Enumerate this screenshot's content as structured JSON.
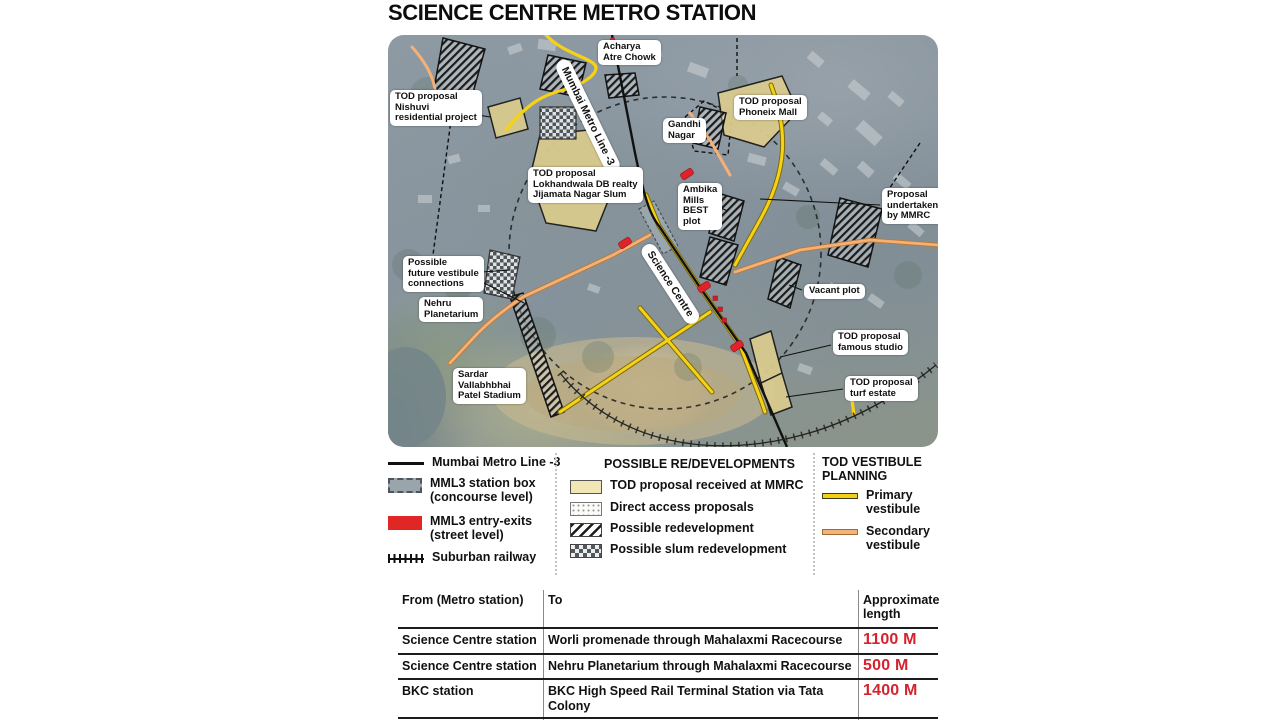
{
  "title": "SCIENCE CENTRE METRO STATION",
  "map": {
    "labels": [
      "Acharya\nAtre Chowk",
      "TOD proposal\nNishuvi\nresidential project",
      "TOD proposal\nPhoneix Mall",
      "Gandhi\nNagar",
      "TOD proposal\nLokhandwala DB realty\nJijamata Nagar Slum",
      "Ambika\nMills\nBEST\nplot",
      "Proposal\nundertaken\nby MMRC",
      "Possible\nfuture vestibule\nconnections",
      "Nehru\nPlanetarium",
      "Vacant plot",
      "TOD proposal\nfamous studio",
      "TOD proposal\nturf estate",
      "Sardar\nVallabhbhai\nPatel Stadium"
    ],
    "line_labels": [
      "Mumbai Metro Line -3",
      "Science Centre"
    ]
  },
  "legend": {
    "col1": {
      "items": [
        "Mumbai Metro Line -3",
        "MML3 station box\n(concourse level)",
        "MML3 entry-exits\n(street level)",
        "Suburban railway"
      ]
    },
    "col2": {
      "header": "POSSIBLE RE/DEVELOPMENTS",
      "items": [
        "TOD proposal received at MMRC",
        "Direct access proposals",
        "Possible redevelopment",
        "Possible slum redevelopment"
      ]
    },
    "col3": {
      "header": "TOD VESTIBULE\nPLANNING",
      "items": [
        "Primary\nvestibule",
        "Secondary\nvestibule"
      ]
    }
  },
  "table": {
    "headers": [
      "From (Metro station)",
      "To",
      "Approximate\nlength"
    ],
    "rows": [
      {
        "from": "Science Centre station",
        "to": "Worli promenade through Mahalaxmi Racecourse",
        "length": "1100 M"
      },
      {
        "from": "Science Centre station",
        "to": "Nehru Planetarium through Mahalaxmi Racecourse",
        "length": "500 M"
      },
      {
        "from": "BKC station",
        "to": "BKC High Speed Rail Terminal Station via Tata Colony",
        "length": "1400 M"
      },
      {
        "from": "",
        "to": "Total approximate length",
        "length": "3000 M"
      }
    ]
  },
  "colors": {
    "accent_red": "#d4232e",
    "tod_fill": "#d9ca8e",
    "primary_vestibule": "#f2d119",
    "secondary_vestibule": "#f3b277",
    "entry_exit_red": "#e12726",
    "station_box_gray": "#9aa5ab"
  }
}
